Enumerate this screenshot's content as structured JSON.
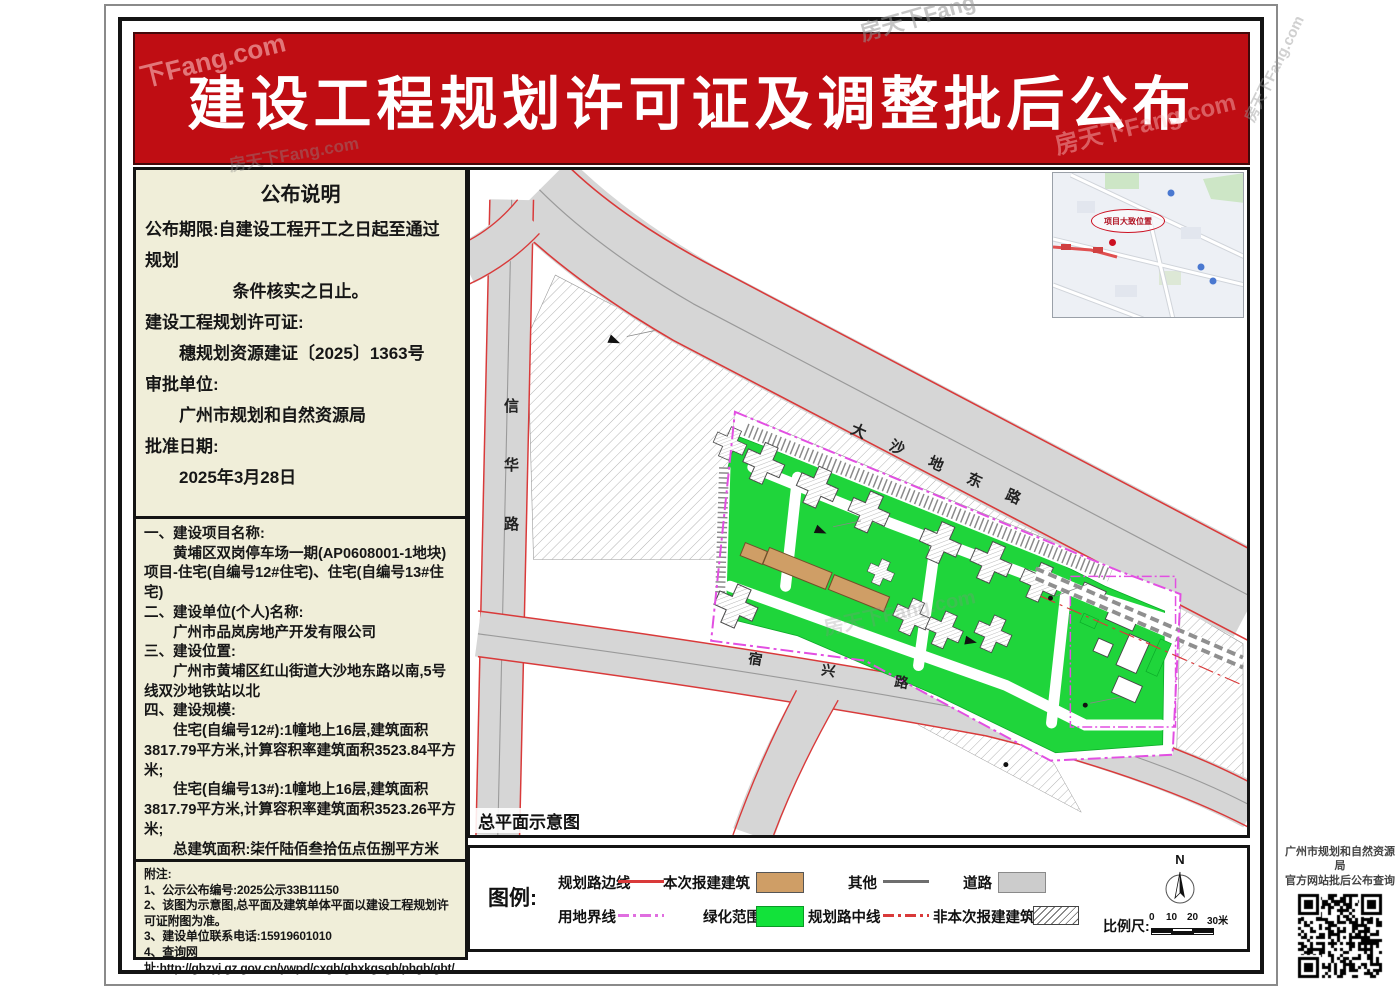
{
  "watermarks": {
    "full": "房天下Fang.com",
    "brand": "房天下Fang",
    "short": "下Fang.com"
  },
  "banner": {
    "title": "建设工程规划许可证及调整批后公布"
  },
  "notice": {
    "title": "公布说明",
    "lines": [
      "公布期限:自建设工程开工之日起至通过规划",
      "条件核实之日止。",
      "建设工程规划许可证:",
      "穗规划资源建证〔2025〕1363号",
      "审批单位:",
      "广州市规划和自然资源局",
      "批准日期:",
      "2025年3月28日"
    ]
  },
  "details": {
    "lines": [
      "一、建设项目名称:",
      "黄埔区双岗停车场一期(AP0608001-1地块)项目-住宅(自编号12#住宅)、住宅(自编号13#住宅)",
      "二、建设单位(个人)名称:",
      "广州市品岚房地产开发有限公司",
      "三、建设位置:",
      "广州市黄埔区红山街道大沙地东路以南,5号线双沙地铁站以北",
      "四、建设规模:",
      "住宅(自编号12#):1幢地上16层,建筑面积3817.79平方米,计算容积率建筑面积3523.84平方米;",
      "住宅(自编号13#):1幢地上16层,建筑面积3817.79平方米,计算容积率建筑面积3523.26平方米;",
      "总建筑面积:柒仟陆佰叁拾伍点伍捌平方米(7635.58㎡),总计算容积率建筑面积:柒仟零肆拾柒点壹零平方米(7047.10㎡)。"
    ]
  },
  "notes": {
    "lines": [
      "附注:",
      "1、公示公布编号:2025公示33B11150",
      "2、该图为示意图,总平面及建筑单体平面以建设工程规划许可证附图为准。",
      "3、建设单位联系电话:15919601010",
      "4、查询网址:http://ghzyj.gz.gov.cn/ywpd/cxgh/ghxkgsgb/phgb/gbt/"
    ]
  },
  "map": {
    "caption": "总平面示意图",
    "roads": {
      "xinhua": "信华路",
      "dashadi": "大沙地东路",
      "suxing": "宿兴路"
    },
    "inset": {
      "callout": "项目大致位置"
    }
  },
  "legend": {
    "title": "图例:",
    "row1": [
      {
        "label": "规划路边线"
      },
      {
        "label": "本次报建建筑"
      },
      {
        "label": "其他"
      },
      {
        "label": "道路"
      }
    ],
    "row2": [
      {
        "label": "用地界线"
      },
      {
        "label": "绿化范围"
      },
      {
        "label": "规划路中线"
      },
      {
        "label": "非本次报建建筑"
      }
    ],
    "north": "N",
    "scale": {
      "label": "比例尺:",
      "ticks": [
        "0",
        "10",
        "20",
        "30米"
      ]
    }
  },
  "qr": {
    "line1": "广州市规划和自然资源局",
    "line2": "官方网站批后公布查询"
  },
  "colors": {
    "banner_red": "#bf0d13",
    "panel_beige": "#f0eed9",
    "green": "#1fd53b",
    "tan": "#cf9e66",
    "road_gray": "#d6d6d6",
    "boundary_magenta": "#e24fe2",
    "road_edge_red": "#d93a3a"
  }
}
